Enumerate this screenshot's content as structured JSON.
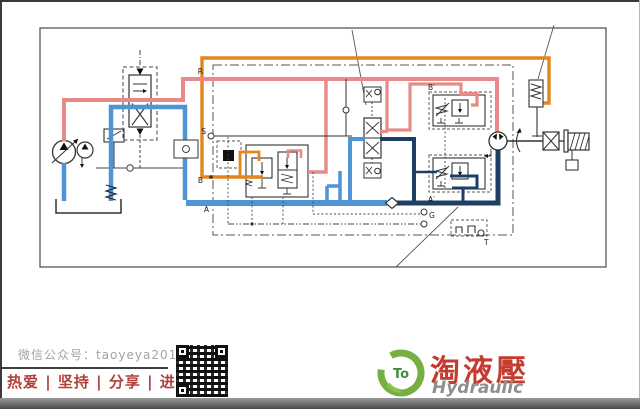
{
  "diagram": {
    "port_labels": {
      "r": "R",
      "s": "S",
      "b": "B",
      "a": "A",
      "b_prime": "B′",
      "a_prime": "A′",
      "g": "G",
      "t": "T"
    },
    "colors": {
      "pressure_line_red": "#e78a88",
      "pilot_line_orange": "#e2861e",
      "tank_line_blue": "#4f94d6",
      "return_line_navy": "#1e3f63",
      "schematic_black": "#333333"
    }
  },
  "footer": {
    "wechat_account": "微信公众号：taoyeya2014",
    "slogan": "热爱 | 坚持 | 分享 | 进步"
  },
  "logo": {
    "badge": "To",
    "brand_cn": "淘液壓",
    "brand_en": "Hydraulic"
  }
}
